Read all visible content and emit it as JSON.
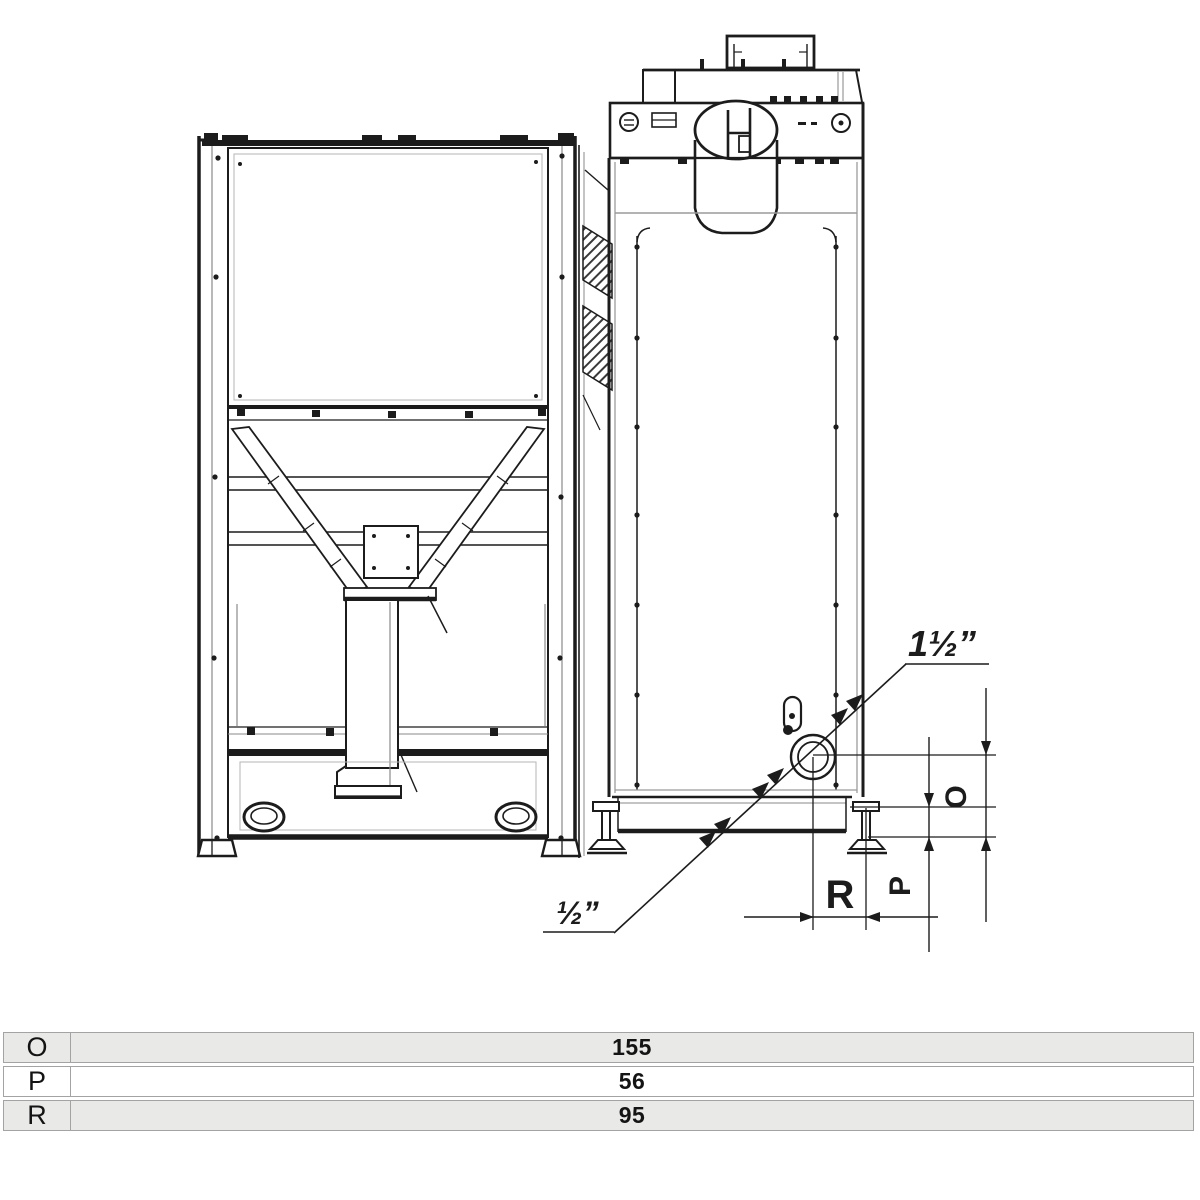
{
  "drawing": {
    "title": "boiler-and-hopper-side-elevation",
    "callout_large": "1½”",
    "callout_small": "½”",
    "dim_o_label": "O",
    "dim_p_label": "P",
    "dim_r_label": "R"
  },
  "table": {
    "rows": [
      {
        "label": "O",
        "value": "155"
      },
      {
        "label": "P",
        "value": "56"
      },
      {
        "label": "R",
        "value": "95"
      }
    ]
  },
  "colors": {
    "line": "#1c1c1c",
    "gray_line": "#909090",
    "table_row_alt": "#e9e9e7",
    "table_border": "#a3a3a3"
  }
}
